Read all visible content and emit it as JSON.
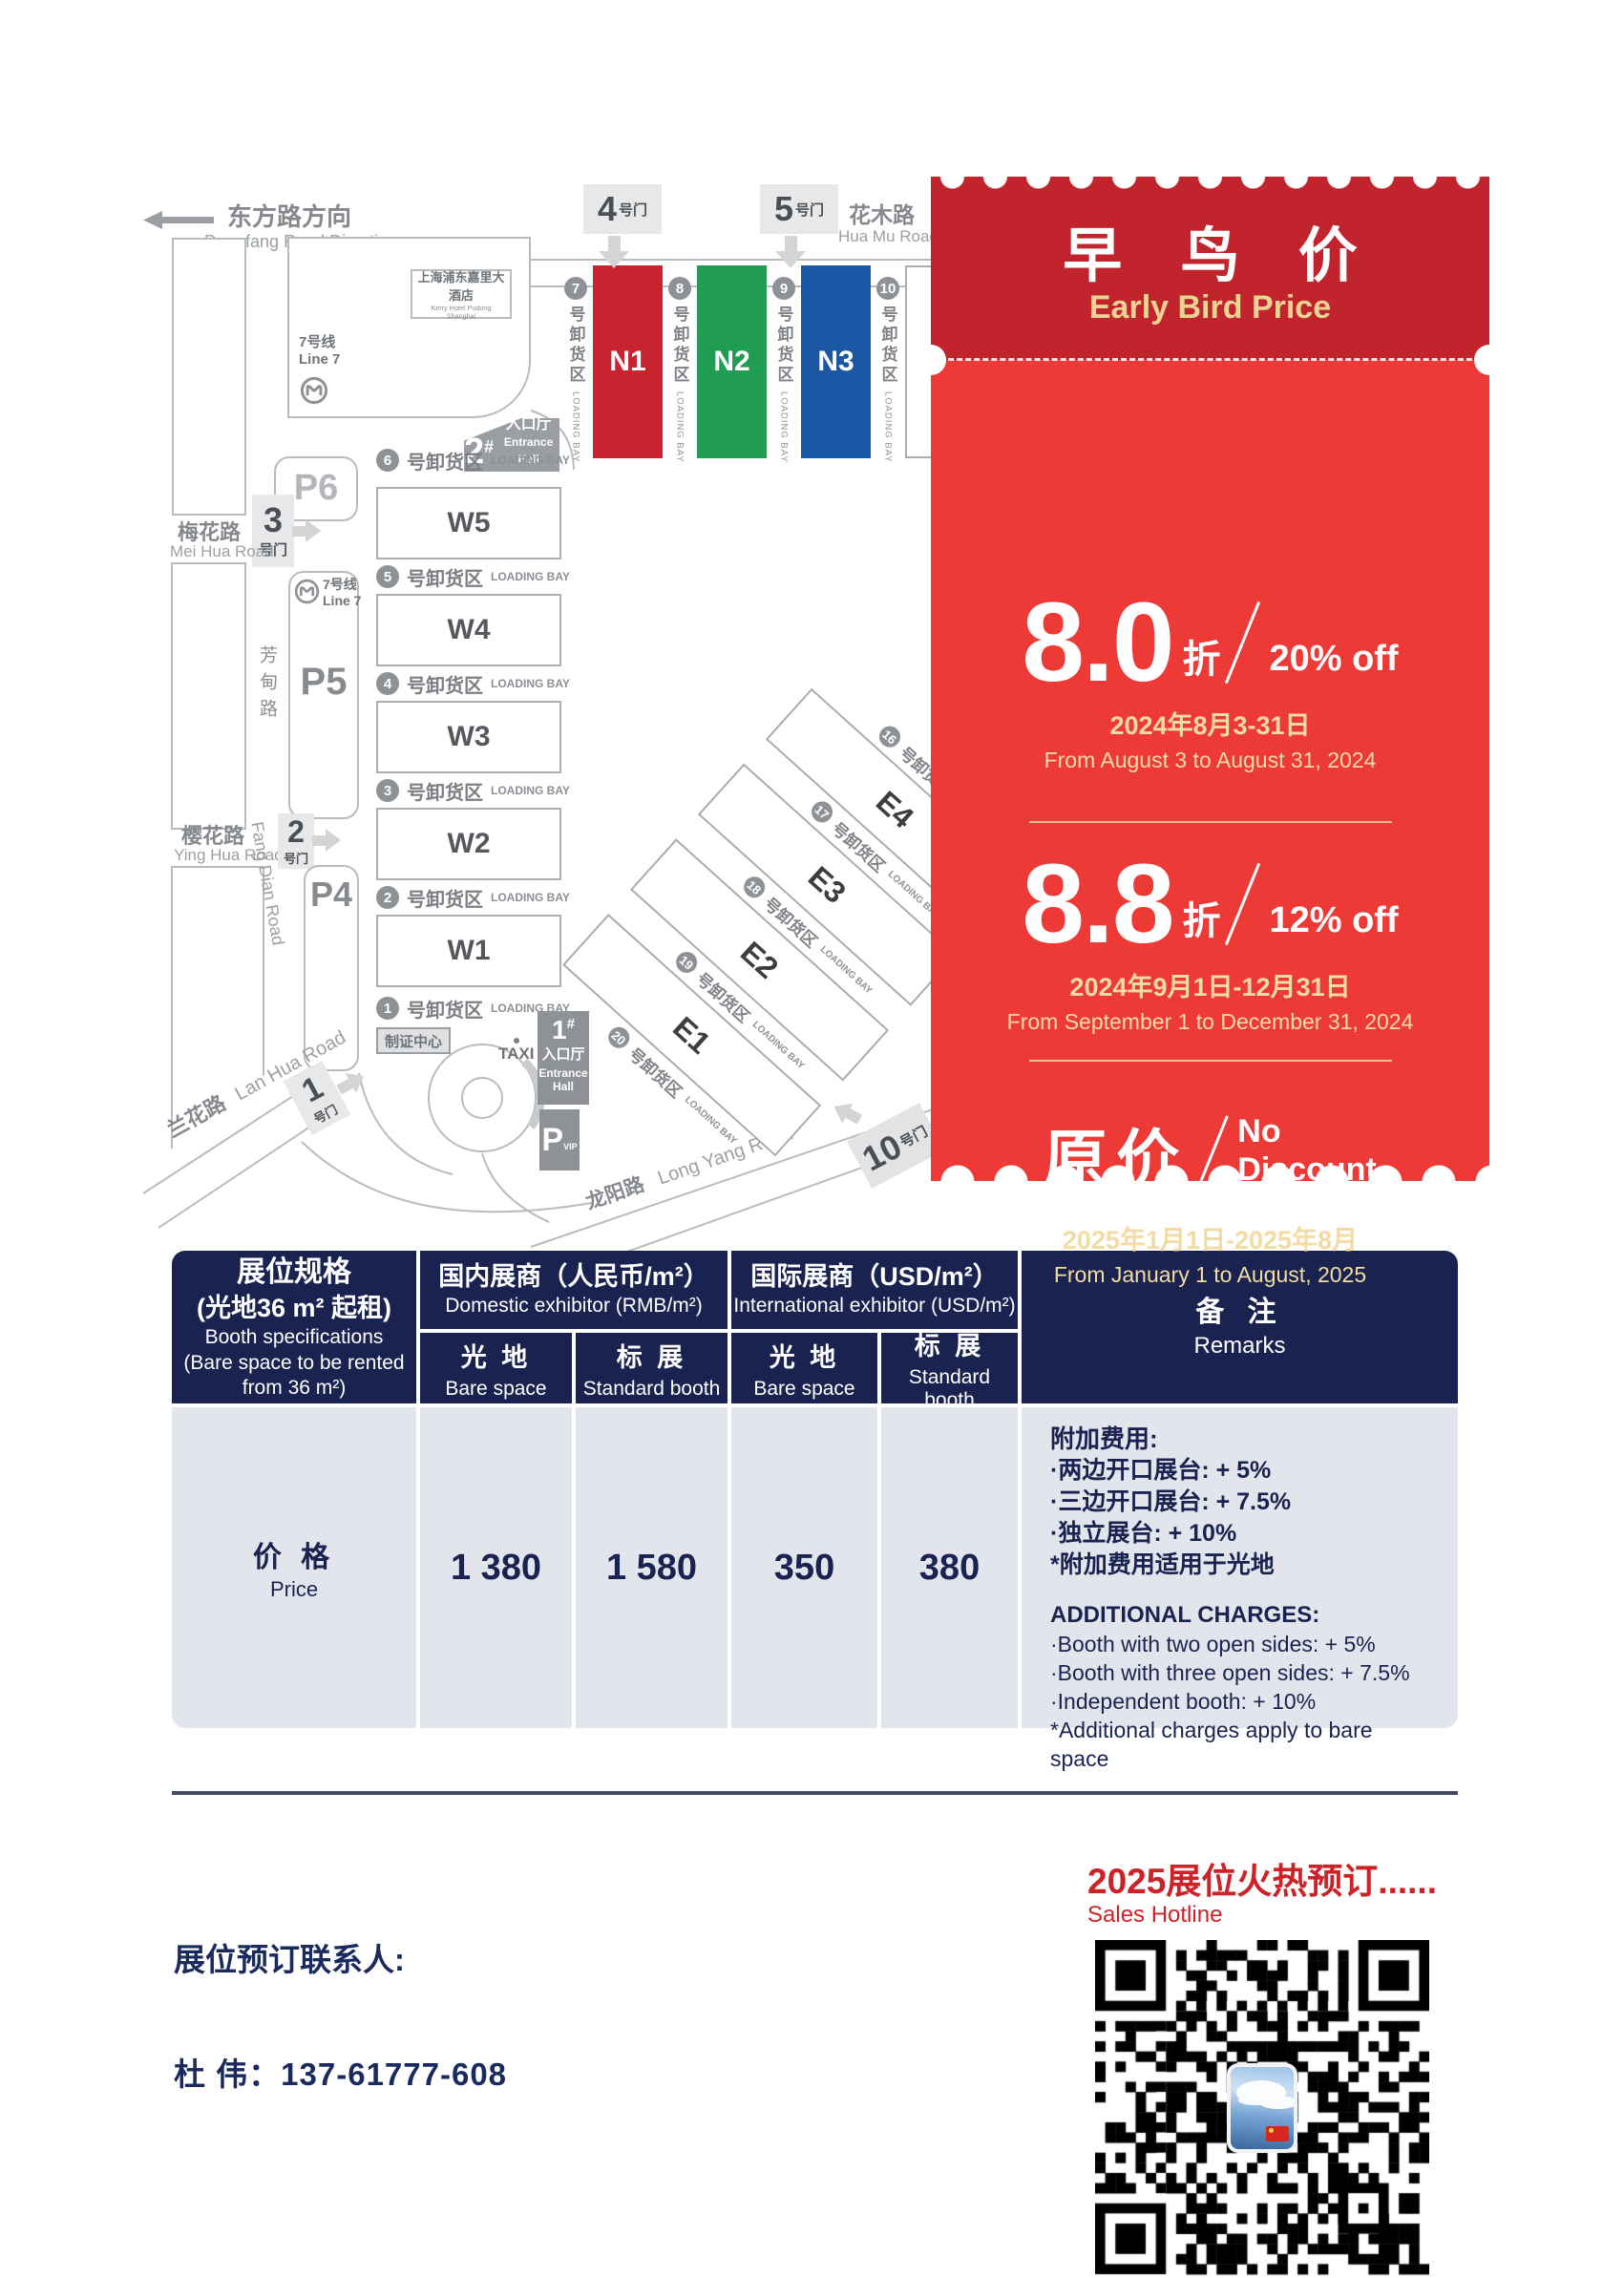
{
  "map": {
    "direction_zh": "东方路方向",
    "direction_en": "Dongfang Road Direction",
    "hua_mu_zh": "花木路",
    "hua_mu_en": "Hua Mu Road",
    "mei_hua_zh": "梅花路",
    "mei_hua_en": "Mei Hua Road",
    "fang_dian_zh": "芳甸路",
    "fang_dian_en": "Fang Dian Road",
    "ying_hua_zh": "樱花路",
    "ying_hua_en": "Ying Hua Road",
    "lan_hua_zh": "兰花路",
    "lan_hua_en": "Lan Hua Road",
    "long_yang_zh": "龙阳路",
    "long_yang_en": "Long Yang Road",
    "hotel_zh": "上海浦东嘉里大酒店",
    "hotel_en": "Kerry Hotel Pudong Shanghai",
    "line7_zh": "7号线",
    "line7_en": "Line 7",
    "taxi": "TAXI",
    "badge_center": "制证中心",
    "p6": "P6",
    "p5": "P5",
    "p4": "P4",
    "p_vip": "P",
    "vip_sub": "VIP",
    "entrance2": {
      "num": "2",
      "sup": "#",
      "zh": "入口厅",
      "en": "Entrance Hall"
    },
    "entrance1": {
      "num": "1",
      "sup": "#",
      "zh": "入口厅",
      "en1": "Entrance",
      "en2": "Hall"
    },
    "gate4": {
      "num": "4",
      "suffix": "号门"
    },
    "gate5": {
      "num": "5",
      "suffix": "号门"
    },
    "gate3": {
      "num": "3",
      "suffix": "号门"
    },
    "gate2": {
      "num": "2",
      "suffix": "号门"
    },
    "gate1": {
      "num": "1",
      "suffix": "号门"
    },
    "gate10": {
      "num": "10",
      "suffix": "号门"
    },
    "loading_zh": "号卸货区",
    "loading_en": "LOADING BAY",
    "n_halls": [
      {
        "bay": "7",
        "hall": "N1",
        "color": "#C8232E",
        "text": "#ffffff"
      },
      {
        "bay": "8",
        "hall": "N2",
        "color": "#219D53",
        "text": "#ffffff"
      },
      {
        "bay": "9",
        "hall": "N3",
        "color": "#1C57A6",
        "text": "#ffffff"
      },
      {
        "bay": "10",
        "hall": "N4",
        "color": "#ffffff",
        "text": "#3b3e41"
      }
    ],
    "w_bays": [
      "6",
      "5",
      "4",
      "3",
      "2",
      "1"
    ],
    "w_halls": [
      "W5",
      "W4",
      "W3",
      "W2",
      "W1"
    ],
    "e_stack": [
      {
        "t": "b",
        "v": "16"
      },
      {
        "t": "h",
        "v": "E4"
      },
      {
        "t": "b",
        "v": "17"
      },
      {
        "t": "h",
        "v": "E3"
      },
      {
        "t": "b",
        "v": "18"
      },
      {
        "t": "h",
        "v": "E2"
      },
      {
        "t": "b",
        "v": "19"
      },
      {
        "t": "h",
        "v": "E1"
      },
      {
        "t": "b",
        "v": "20"
      }
    ]
  },
  "ticket": {
    "title_zh": "早 鸟 价",
    "title_en": "Early Bird Price",
    "tiers": [
      {
        "num": "8.0",
        "unit": "折",
        "off": "20% off",
        "date_zh": "2024年8月3-31日",
        "date_en": "From August 3 to August 31, 2024"
      },
      {
        "num": "8.8",
        "unit": "折",
        "off": "12% off",
        "date_zh": "2024年9月1日-12月31日",
        "date_en": "From September 1 to December 31, 2024"
      },
      {
        "zh": "原价",
        "off1": "No",
        "off2": "Discount",
        "date_zh": "2025年1月1日-2025年8月",
        "date_en": "From January 1 to August, 2025"
      }
    ],
    "colors": {
      "top": "#C2242E",
      "body": "#EE3A36",
      "gold": "#F2DCA4"
    }
  },
  "table": {
    "spec": {
      "zh1": "展位规格",
      "zh2": "(光地36 m² 起租)",
      "en1": "Booth specifications",
      "en2": "(Bare space to be rented",
      "en3": "from 36 m²)"
    },
    "domestic": {
      "zh": "国内展商（人民币/m²）",
      "en": "Domestic exhibitor (RMB/m²)"
    },
    "international": {
      "zh": "国际展商（USD/m²）",
      "en": "International exhibitor (USD/m²)"
    },
    "sub": {
      "bare_zh": "光 地",
      "bare_en": "Bare space",
      "std_zh": "标 展",
      "std_en": "Standard booth"
    },
    "remarks_header": {
      "zh": "备 注",
      "en": "Remarks"
    },
    "price_row": {
      "label_zh": "价 格",
      "label_en": "Price",
      "values": [
        "1 380",
        "1 580",
        "350",
        "380"
      ]
    },
    "remarks_zh": {
      "title": "附加费用:",
      "items": [
        "·两边开口展台: + 5%",
        "·三边开口展台: + 7.5%",
        "·独立展台: + 10%",
        "*附加费用适用于光地"
      ]
    },
    "remarks_en": {
      "title": "ADDITIONAL CHARGES:",
      "items": [
        "·Booth with two open sides: + 5%",
        "·Booth with three open sides: + 7.5%",
        "·Independent booth: + 10%",
        "*Additional charges apply to bare space"
      ]
    }
  },
  "footer": {
    "hotline_zh": "2025展位火热预订......",
    "hotline_en": "Sales Hotline",
    "contact_label": "展位预订联系人:",
    "contact": "杜  伟：137-61777-608"
  },
  "colors": {
    "navy": "#1A2350",
    "red_dark": "#C2242E",
    "red": "#EE3A36",
    "gold": "#F2DCA4",
    "body_gray": "#E2E6EC",
    "footer_red": "#CC2228"
  }
}
